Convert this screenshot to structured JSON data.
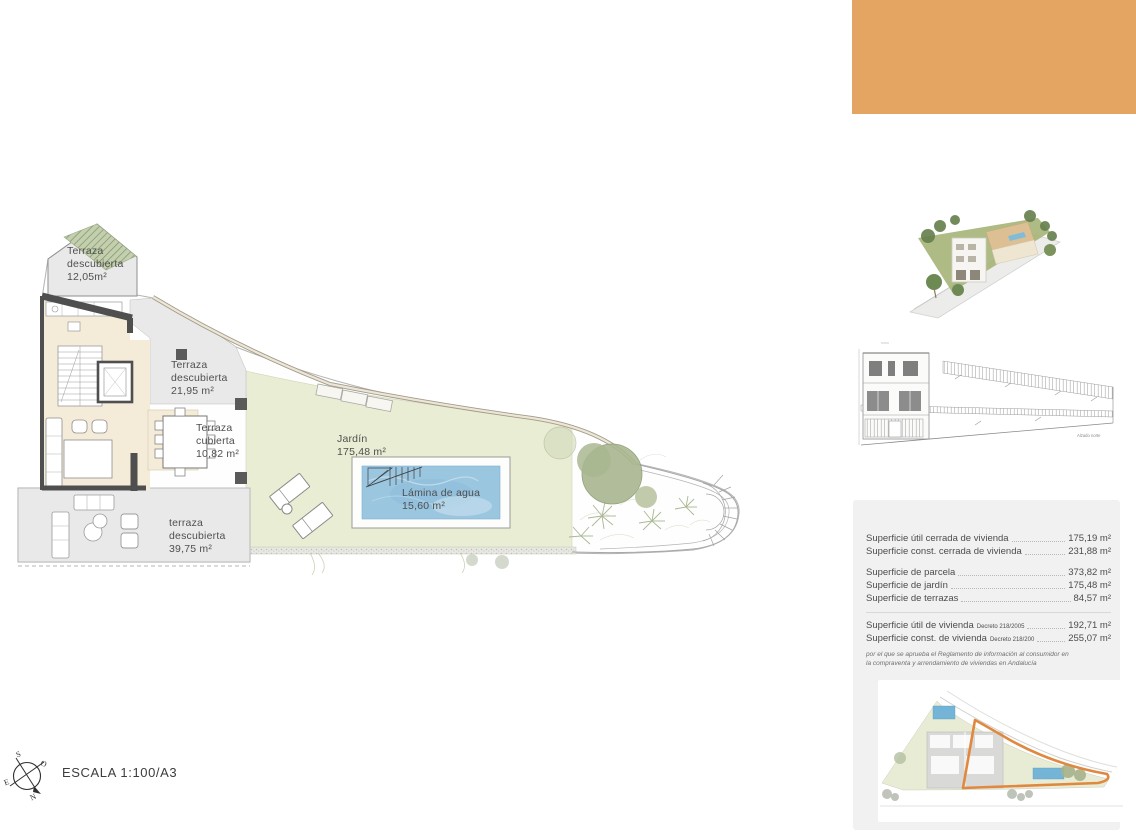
{
  "banner": {
    "color": "#e4a562"
  },
  "plan_labels": {
    "terrace_top": "Terraza\ndescubierta\n12,05m²",
    "terrace_upper": "Terraza\ndescubierta\n21,95 m²",
    "terrace_covered": "Terraza\ncubierta\n10,82 m²",
    "garden": "Jardín\n175,48 m²",
    "pool": "Lámina de agua\n15,60 m²",
    "terrace_lower": "terraza\ndescubierta\n39,75 m²"
  },
  "summary": {
    "group1": [
      {
        "label": "Superficie útil cerrada de vivienda",
        "value": "175,19 m²"
      },
      {
        "label": "Superficie const. cerrada de vivienda",
        "value": "231,88 m²"
      }
    ],
    "group2": [
      {
        "label": "Superficie de parcela",
        "value": "373,82 m²"
      },
      {
        "label": "Superficie de jardín",
        "value": "175,48 m²"
      },
      {
        "label": "Superficie de terrazas",
        "value": "84,57 m²"
      }
    ],
    "group3": [
      {
        "label": "Superficie útil de vivienda",
        "decree": "Decreto 218/2005",
        "value": "192,71 m²"
      },
      {
        "label": "Superficie const. de vivienda",
        "decree": "Decreto 218/200",
        "value": "255,07 m²"
      }
    ],
    "note": "por el que se aprueba el Reglamento de información al consumidor en la compraventa y arrendamiento de viviendas en Andalucía"
  },
  "elevation": {
    "caption": "Alzado norte"
  },
  "compass": {
    "n": "N",
    "s": "S",
    "e": "E",
    "o": "O"
  },
  "scale_text": "ESCALA 1:100/A3",
  "colors": {
    "banner_orange": "#e4a562",
    "garden_green": "#e9edd3",
    "pool_blue": "#9ac6e0",
    "terrace_gray": "#e9e9e9",
    "interior_cream": "#f4ecd9",
    "wall_dark": "#4f4f4f",
    "highlight_orange": "#e0883f"
  }
}
